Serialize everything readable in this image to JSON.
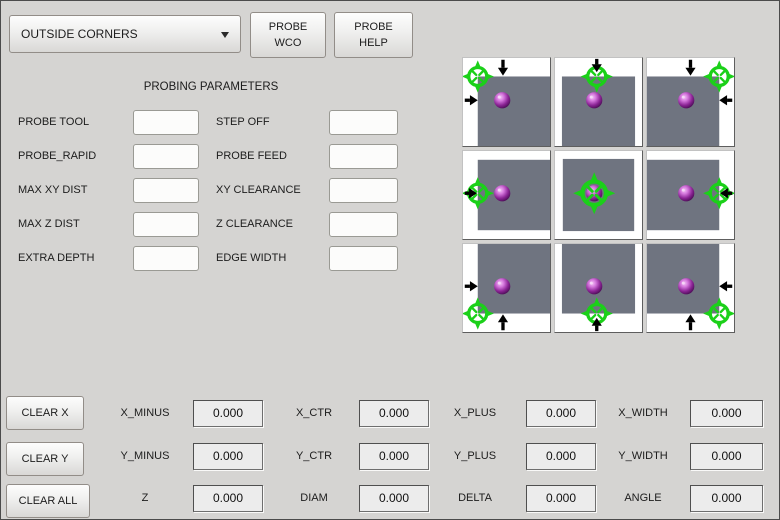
{
  "header": {
    "mode_dropdown": {
      "value": "OUTSIDE CORNERS"
    },
    "probe_wco_button": {
      "line1": "PROBE",
      "line2": "WCO"
    },
    "probe_help_button": {
      "line1": "PROBE",
      "line2": "HELP"
    }
  },
  "parameters": {
    "title": "PROBING PARAMETERS",
    "rows": [
      {
        "left_label": "PROBE TOOL",
        "left_value": "",
        "right_label": "STEP OFF",
        "right_value": ""
      },
      {
        "left_label": "PROBE_RAPID",
        "left_value": "",
        "right_label": "PROBE FEED",
        "right_value": ""
      },
      {
        "left_label": "MAX XY DIST",
        "left_value": "",
        "right_label": "XY CLEARANCE",
        "right_value": ""
      },
      {
        "left_label": "MAX Z DIST",
        "left_value": "",
        "right_label": "Z CLEARANCE",
        "right_value": ""
      },
      {
        "left_label": "EXTRA DEPTH",
        "left_value": "",
        "right_label": "EDGE WIDTH",
        "right_value": ""
      }
    ]
  },
  "probe_image": {
    "colors": {
      "square": "#6f7480",
      "target": "#1bd019",
      "arrow": "#000000",
      "sphere_highlight": "#f4c4f6",
      "sphere_light": "#d476dc",
      "sphere_mid": "#8c2596",
      "sphere_outer": "#41094b"
    },
    "sphere": {
      "x": 45,
      "y": 48
    },
    "cells": [
      {
        "id": "top-left-corner",
        "square": {
          "top": 21,
          "left": 17,
          "right": 0,
          "bottom": 0
        },
        "target": {
          "x": 17,
          "y": 21
        },
        "arrows": [
          {
            "x1": 46,
            "y1": 2,
            "x2": 46,
            "y2": 20
          },
          {
            "x1": 2,
            "y1": 48,
            "x2": 17,
            "y2": 48
          }
        ]
      },
      {
        "id": "top-edge",
        "square": {
          "top": 21,
          "left": 8,
          "right": 8,
          "bottom": 0
        },
        "target": {
          "x": 48,
          "y": 21
        },
        "arrows": [
          {
            "x1": 48,
            "y1": 1,
            "x2": 48,
            "y2": 16
          }
        ]
      },
      {
        "id": "top-right-corner",
        "square": {
          "top": 21,
          "left": 0,
          "right": 17,
          "bottom": 0
        },
        "target": {
          "x": 83,
          "y": 21
        },
        "arrows": [
          {
            "x1": 50,
            "y1": 2,
            "x2": 50,
            "y2": 20
          },
          {
            "x1": 98,
            "y1": 48,
            "x2": 83,
            "y2": 48
          }
        ]
      },
      {
        "id": "left-edge",
        "square": {
          "top": 10,
          "left": 17,
          "right": 0,
          "bottom": 10
        },
        "target": {
          "x": 17,
          "y": 48
        },
        "arrows": [
          {
            "x1": 2,
            "y1": 48,
            "x2": 16,
            "y2": 48
          }
        ]
      },
      {
        "id": "center",
        "square": {
          "top": 9,
          "left": 9,
          "right": 9,
          "bottom": 9
        },
        "target": {
          "x": 45,
          "y": 48,
          "s": 1.3
        },
        "arrows": []
      },
      {
        "id": "right-edge",
        "square": {
          "top": 10,
          "left": 0,
          "right": 17,
          "bottom": 10
        },
        "target": {
          "x": 83,
          "y": 48
        },
        "arrows": [
          {
            "x1": 98,
            "y1": 48,
            "x2": 84,
            "y2": 48
          }
        ]
      },
      {
        "id": "bottom-left-corner",
        "square": {
          "top": 0,
          "left": 17,
          "right": 0,
          "bottom": 21
        },
        "target": {
          "x": 17,
          "y": 79
        },
        "arrows": [
          {
            "x1": 2,
            "y1": 48,
            "x2": 17,
            "y2": 48
          },
          {
            "x1": 46,
            "y1": 98,
            "x2": 46,
            "y2": 80
          }
        ]
      },
      {
        "id": "bottom-edge",
        "square": {
          "top": 0,
          "left": 8,
          "right": 8,
          "bottom": 21
        },
        "target": {
          "x": 48,
          "y": 79
        },
        "arrows": [
          {
            "x1": 48,
            "y1": 99,
            "x2": 48,
            "y2": 84
          }
        ]
      },
      {
        "id": "bottom-right-corner",
        "square": {
          "top": 0,
          "left": 0,
          "right": 17,
          "bottom": 21
        },
        "target": {
          "x": 83,
          "y": 79
        },
        "arrows": [
          {
            "x1": 98,
            "y1": 48,
            "x2": 83,
            "y2": 48
          },
          {
            "x1": 50,
            "y1": 98,
            "x2": 50,
            "y2": 80
          }
        ]
      }
    ]
  },
  "results": {
    "clear_x_button": "CLEAR X",
    "clear_y_button": "CLEAR Y",
    "clear_all_button": "CLEAR ALL",
    "rows": [
      [
        {
          "label": "X_MINUS",
          "value": "0.000"
        },
        {
          "label": "X_CTR",
          "value": "0.000"
        },
        {
          "label": "X_PLUS",
          "value": "0.000"
        },
        {
          "label": "X_WIDTH",
          "value": "0.000"
        }
      ],
      [
        {
          "label": "Y_MINUS",
          "value": "0.000"
        },
        {
          "label": "Y_CTR",
          "value": "0.000"
        },
        {
          "label": "Y_PLUS",
          "value": "0.000"
        },
        {
          "label": "Y_WIDTH",
          "value": "0.000"
        }
      ],
      [
        {
          "label": "Z",
          "value": "0.000"
        },
        {
          "label": "DIAM",
          "value": "0.000"
        },
        {
          "label": "DELTA",
          "value": "0.000"
        },
        {
          "label": "ANGLE",
          "value": "0.000"
        }
      ]
    ]
  }
}
